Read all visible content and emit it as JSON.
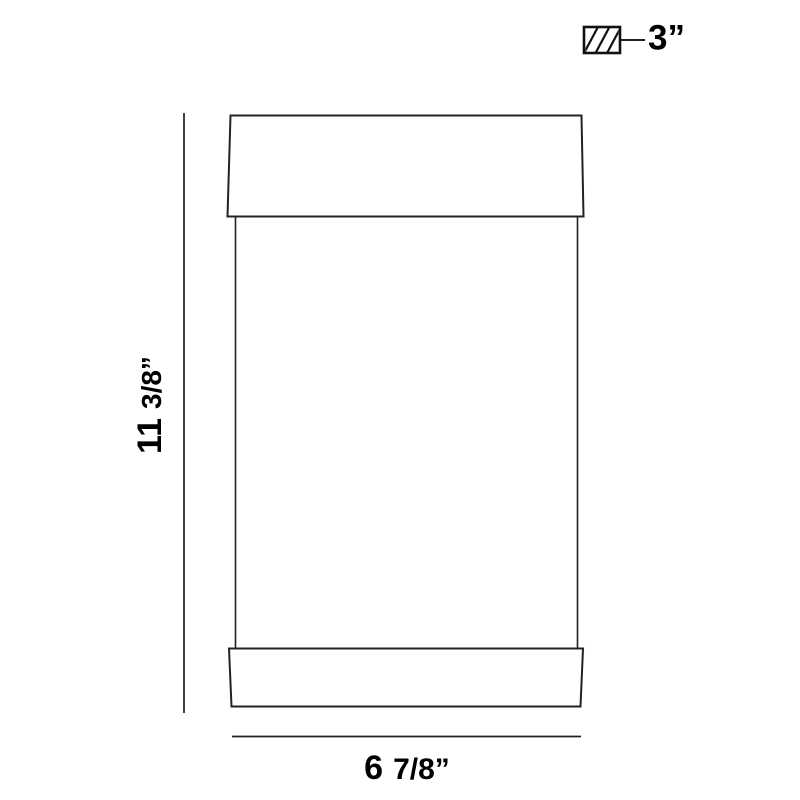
{
  "diagram": {
    "kind": "fixture-dimension-drawing",
    "colors": {
      "background": "#ffffff",
      "line": "#222222",
      "text": "#000000"
    }
  },
  "labels": {
    "height": {
      "whole": "11",
      "fraction": "3/8”"
    },
    "width": {
      "whole": "6",
      "fraction": "7/8”"
    },
    "depth": {
      "value": "3”"
    }
  }
}
